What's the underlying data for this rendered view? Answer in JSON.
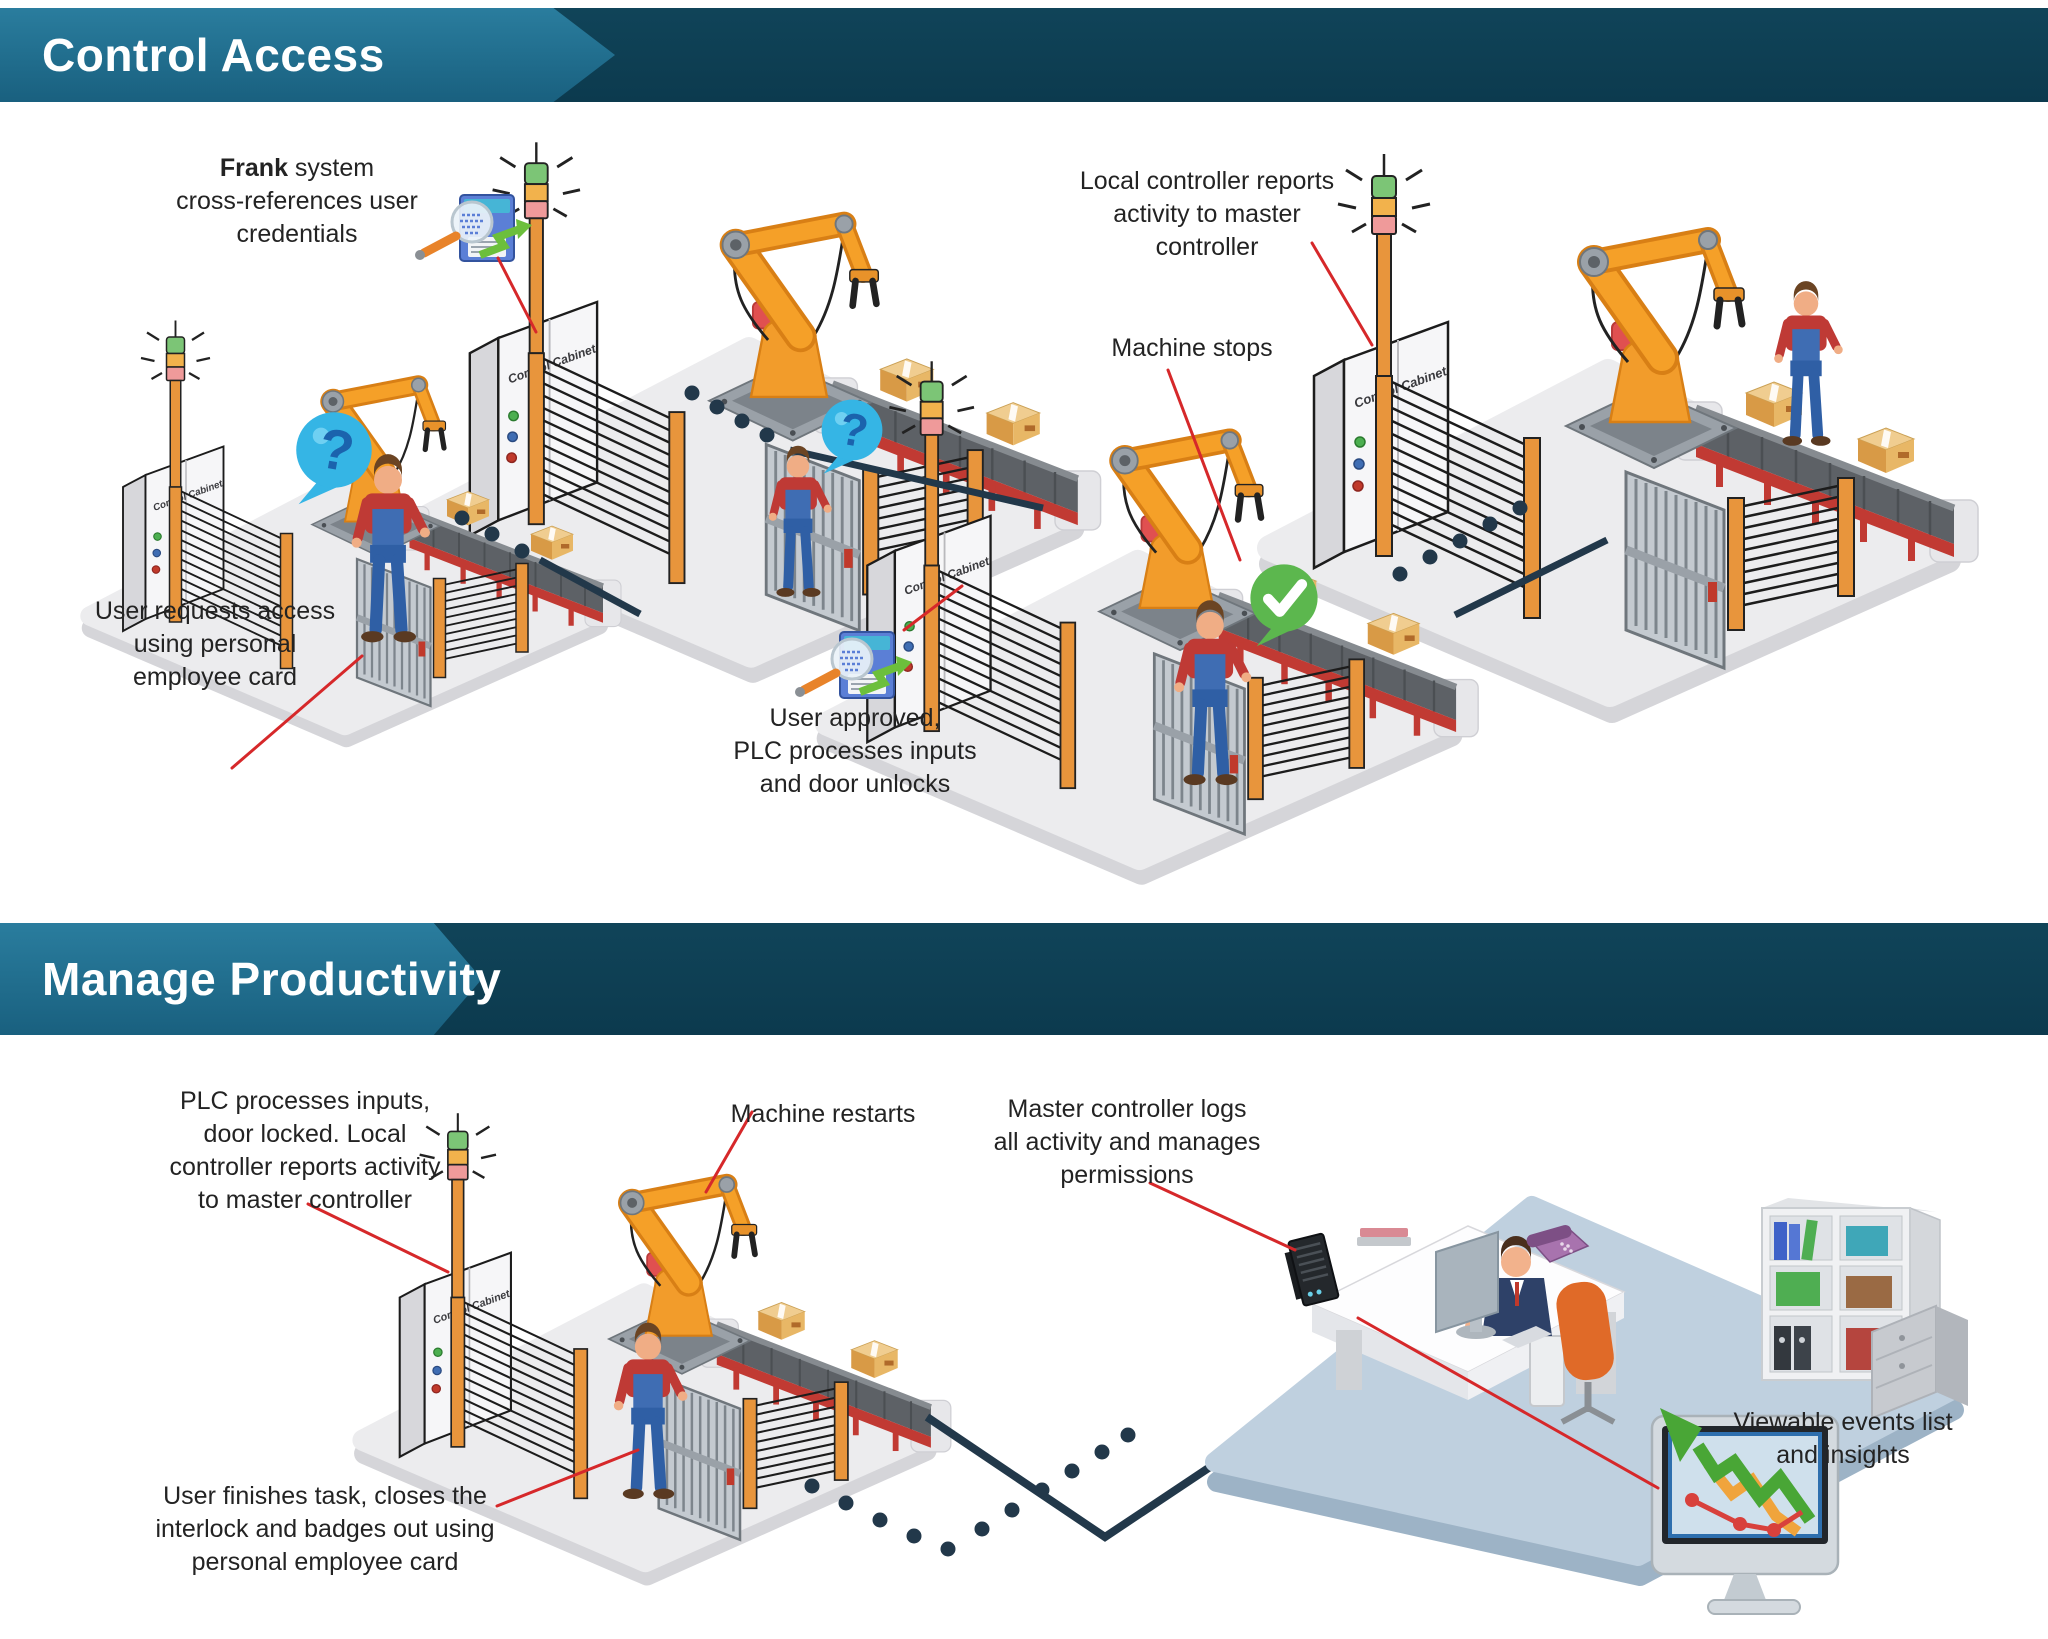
{
  "canvas": {
    "width": 2048,
    "height": 1639,
    "background": "#ffffff"
  },
  "colors": {
    "banner_teal": "#21708f",
    "banner_navy": "#0d3e54",
    "title_text": "#ffffff",
    "annotation_text": "#232323",
    "leader_line": "#d6282a",
    "connector_navy": "#22384a",
    "platform_gray": "#ececee",
    "office_platform_blue": "#bfd0df",
    "robot_orange": "#f29c2b",
    "safety_post_orange": "#e8953c",
    "conveyor_red": "#c13a33",
    "status_question_blue": "#35b5e5",
    "status_ok_green": "#5cb74e"
  },
  "sections": [
    {
      "title": "Control Access",
      "annotations": [
        {
          "id": "frank-system",
          "bold": "Frank",
          "lines": [
            " system",
            "cross-references user",
            "credentials"
          ]
        },
        {
          "id": "user-requests",
          "lines": [
            "User requests access",
            "using personal",
            "employee card"
          ]
        },
        {
          "id": "machine-stops",
          "lines": [
            "Machine stops"
          ]
        },
        {
          "id": "user-approved",
          "lines": [
            "User approved,",
            "PLC processes inputs",
            "and door unlocks"
          ]
        },
        {
          "id": "local-controller",
          "lines": [
            "Local controller reports",
            "activity to master",
            "controller"
          ]
        }
      ]
    },
    {
      "title": "Manage Productivity",
      "annotations": [
        {
          "id": "plc-processes",
          "lines": [
            "PLC processes inputs,",
            "door locked. Local",
            "controller reports activity",
            "to master controller"
          ]
        },
        {
          "id": "machine-restarts",
          "lines": [
            "Machine restarts"
          ]
        },
        {
          "id": "master-controller",
          "lines": [
            "Master controller logs",
            "all activity and manages",
            "permissions"
          ]
        },
        {
          "id": "user-finishes",
          "lines": [
            "User finishes task, closes the",
            "interlock and badges out using",
            "personal employee card"
          ]
        },
        {
          "id": "viewable-events",
          "lines": [
            "Viewable events list",
            "and insights"
          ]
        }
      ]
    }
  ],
  "station": {
    "cabinet_label": "Control Cabinet",
    "question_glyph": "?"
  },
  "icons": [
    "signal-tower-icon",
    "control-cabinet",
    "light-curtain-fence",
    "interlock-gate",
    "robot-arm",
    "conveyor-belt",
    "cardboard-box",
    "worker-figure",
    "question-bubble-icon",
    "check-bubble-icon",
    "credential-scan-icon",
    "leader-line",
    "connector-dotted-line",
    "master-controller-device",
    "office-desk",
    "office-monitor",
    "desk-phone",
    "bookshelf",
    "office-cabinet",
    "office-chair",
    "manager-figure",
    "insights-monitor-icon",
    "trend-arrow-icon"
  ]
}
